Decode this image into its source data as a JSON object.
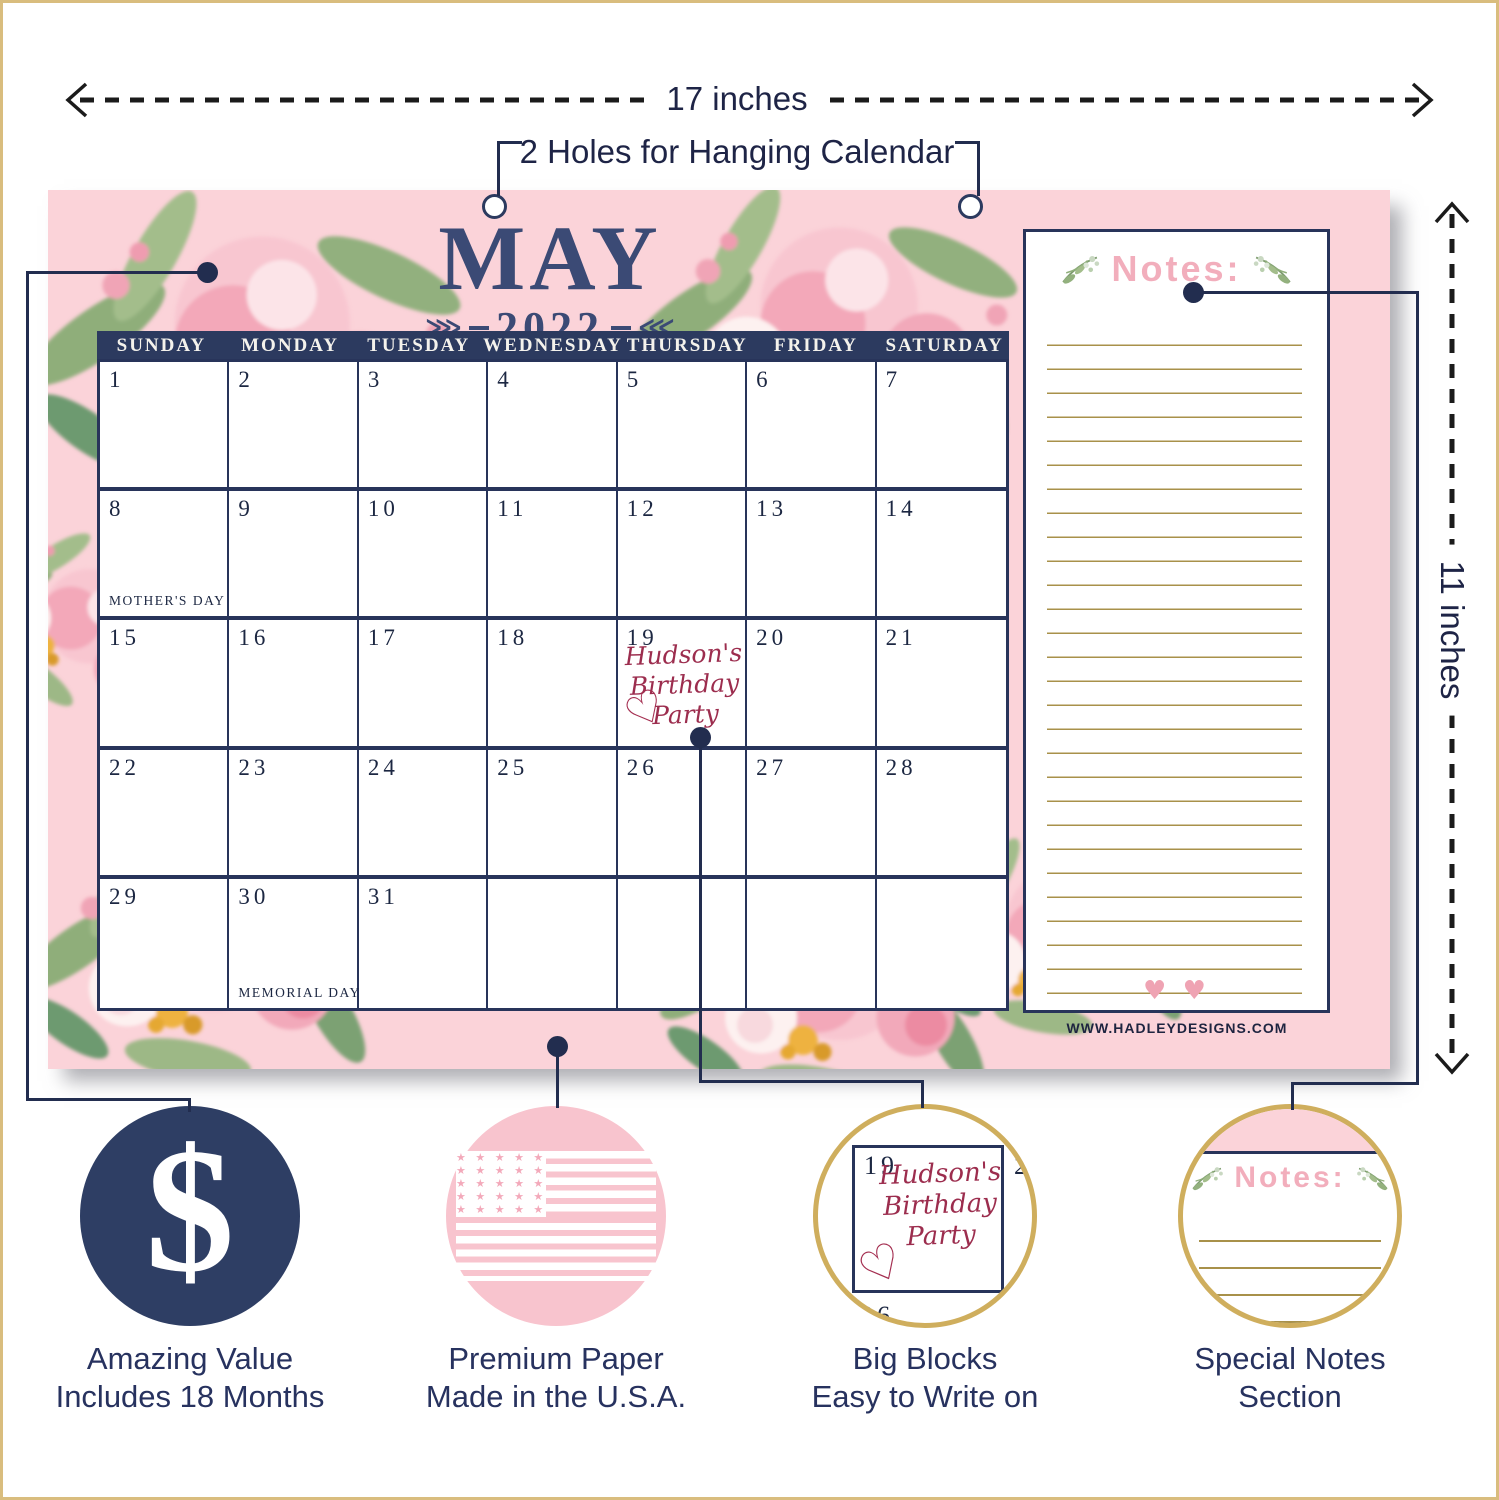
{
  "annotations": {
    "width_dimension": "17 inches",
    "height_dimension": "11 inches",
    "holes_callout": "2 Holes for Hanging Calendar"
  },
  "calendar": {
    "month": "MAY",
    "year": "2022",
    "day_headers": [
      "SUNDAY",
      "MONDAY",
      "TUESDAY",
      "WEDNESDAY",
      "THURSDAY",
      "FRIDAY",
      "SATURDAY"
    ],
    "cells": [
      {
        "date": "1"
      },
      {
        "date": "2"
      },
      {
        "date": "3"
      },
      {
        "date": "4"
      },
      {
        "date": "5"
      },
      {
        "date": "6"
      },
      {
        "date": "7"
      },
      {
        "date": "8",
        "holiday": "MOTHER'S DAY"
      },
      {
        "date": "9"
      },
      {
        "date": "10"
      },
      {
        "date": "11"
      },
      {
        "date": "12"
      },
      {
        "date": "13"
      },
      {
        "date": "14"
      },
      {
        "date": "15"
      },
      {
        "date": "16"
      },
      {
        "date": "17"
      },
      {
        "date": "18"
      },
      {
        "date": "19"
      },
      {
        "date": "20"
      },
      {
        "date": "21"
      },
      {
        "date": "22"
      },
      {
        "date": "23"
      },
      {
        "date": "24"
      },
      {
        "date": "25"
      },
      {
        "date": "26"
      },
      {
        "date": "27"
      },
      {
        "date": "28"
      },
      {
        "date": "29"
      },
      {
        "date": "30",
        "holiday": "MEMORIAL DAY"
      },
      {
        "date": "31"
      },
      {},
      {},
      {},
      {}
    ],
    "event": {
      "line1": "Hudson's",
      "line2": "Birthday",
      "line3": "Party",
      "heart": "♡"
    },
    "website": "WWW.HADLEYDESIGNS.COM"
  },
  "notes": {
    "title": "Notes:",
    "hearts": "♥ ♥"
  },
  "features": {
    "value": {
      "symbol": "$",
      "line1": "Amazing Value",
      "line2": "Includes 18 Months"
    },
    "paper": {
      "stars_row": "★ ★ ★ ★ ★ ★",
      "line1": "Premium Paper",
      "line2": "Made in the U.S.A."
    },
    "blocks": {
      "zoom_date_main": "19",
      "zoom_date_right": "20",
      "zoom_date_below": "26",
      "line1": "Big Blocks",
      "line2": "Easy to Write on"
    },
    "notes_section": {
      "line1": "Special Notes",
      "line2": "Section"
    }
  },
  "colors": {
    "panel_pink": "#fbd3d9",
    "navy": "#2e3e64",
    "grid_navy": "#28345a",
    "gold_border": "#cfae5d",
    "rule_gold": "#a8914a",
    "handwriting_maroon": "#9c2d4e",
    "notes_pink": "#f2aebc",
    "flag_pink": "#f8c4ce"
  }
}
